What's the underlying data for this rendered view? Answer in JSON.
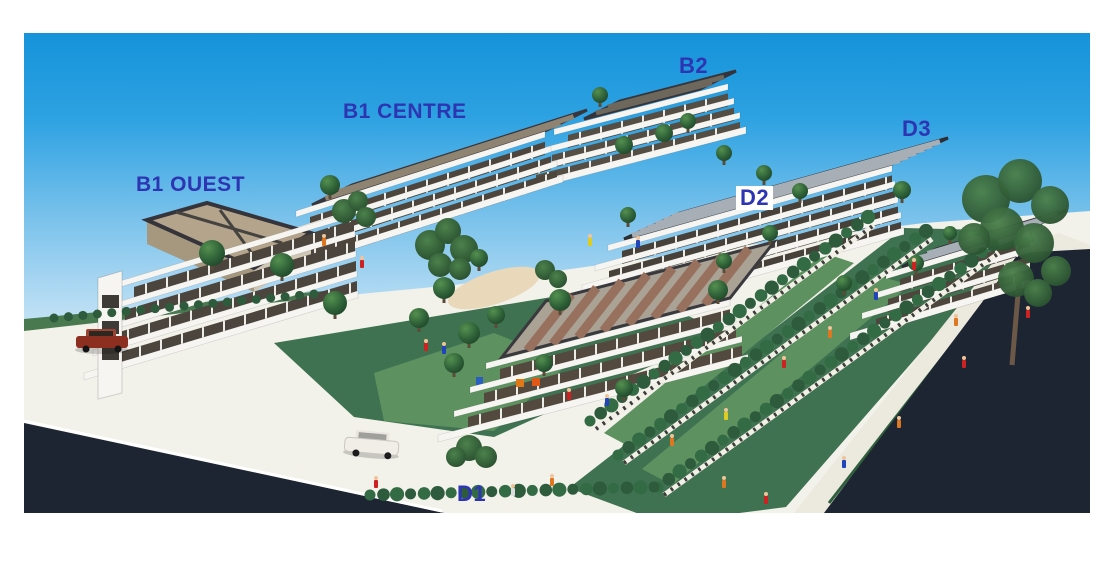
{
  "photo": {
    "alt": "Architectural scale model photo of a terraced apartment complex with labelled buildings"
  },
  "labels": {
    "b1_ouest": "B1 OUEST",
    "b1_centre": "B1 CENTRE",
    "b2": "B2",
    "d1": "D1",
    "d2": "D2",
    "d3": "D3"
  },
  "colors": {
    "label_blue": "#2e35b2",
    "sky_top": "#1593da",
    "sky_mid": "#7fc4ec",
    "sky_horizon": "#eaf5fc",
    "road_dark": "#1d2532",
    "platform_white": "#f2f1ea",
    "building_white": "#f6f5f1",
    "glass_dark": "#4e463d",
    "roof_tan": "#b4a48c",
    "roof_solar": "#50555b",
    "solar_strip": "#a7aeb6",
    "tile_strip": "#97705e",
    "lawn_green": "#3f7250",
    "lawn_light": "#5d9260",
    "hedge_green": "#2d5b3b",
    "tree_green": "#2c5c38",
    "sand_path": "#e9d9ba"
  }
}
